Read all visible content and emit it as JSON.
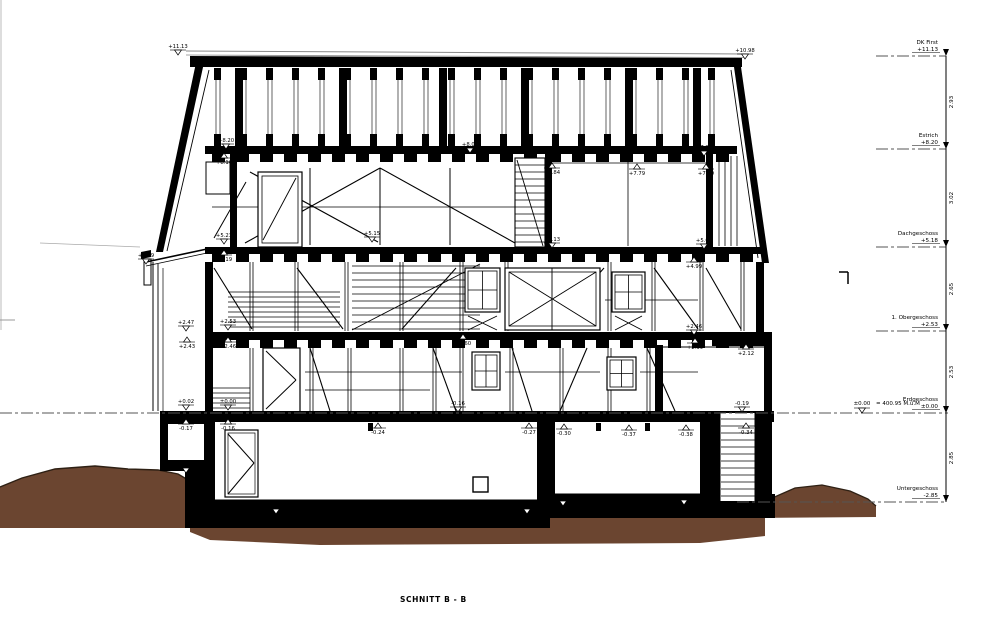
{
  "title": "SCHNITT B - B",
  "datum_note": {
    "label": "±0.00",
    "equals": "= 400.95 M.ü.M"
  },
  "colors": {
    "line": "#000000",
    "soil": "#6B4530",
    "soil_edge": "#2e2014",
    "dash": "#555555",
    "paper": "#ffffff"
  },
  "levels": [
    {
      "name": "DK First",
      "value": "+11.13",
      "y": 56
    },
    {
      "name": "Estrich",
      "value": "+8.20",
      "y": 149
    },
    {
      "name": "Dachgeschoss",
      "value": "+5.18",
      "y": 247
    },
    {
      "name": "1. Obergeschoss",
      "value": "+2.53",
      "y": 331
    },
    {
      "name": "Erdgeschoss",
      "value": "±0.00",
      "y": 413
    },
    {
      "name": "Untergeschoss",
      "value": "-2.85",
      "y": 502
    }
  ],
  "dimensions": [
    {
      "value": "2.93",
      "y": 102
    },
    {
      "value": "3.02",
      "y": 198
    },
    {
      "value": "2.65",
      "y": 289
    },
    {
      "value": "2.53",
      "y": 372
    },
    {
      "value": "2.85",
      "y": 458
    }
  ],
  "annotations": [
    {
      "label": "+11.13",
      "x": 178,
      "y": 46,
      "dir": "down"
    },
    {
      "label": "+10.98",
      "x": 745,
      "y": 50,
      "dir": "down"
    },
    {
      "label": "+8.20",
      "x": 226,
      "y": 140,
      "dir": "down"
    },
    {
      "label": "+8.16",
      "x": 224,
      "y": 162,
      "dir": "up"
    },
    {
      "label": "+8.04",
      "x": 470,
      "y": 144,
      "dir": "down"
    },
    {
      "label": "+7.99",
      "x": 704,
      "y": 147,
      "dir": "down"
    },
    {
      "label": "+7.84",
      "x": 552,
      "y": 172,
      "dir": "up"
    },
    {
      "label": "+7.79",
      "x": 637,
      "y": 173,
      "dir": "up"
    },
    {
      "label": "+7.79",
      "x": 706,
      "y": 173,
      "dir": "up"
    },
    {
      "label": "+5.23",
      "x": 224,
      "y": 235,
      "dir": "down"
    },
    {
      "label": "+5.19",
      "x": 224,
      "y": 259,
      "dir": "up"
    },
    {
      "label": "+5.15",
      "x": 372,
      "y": 233,
      "dir": "down"
    },
    {
      "label": "+5.13",
      "x": 552,
      "y": 239,
      "dir": "down"
    },
    {
      "label": "+5.05",
      "x": 704,
      "y": 240,
      "dir": "down"
    },
    {
      "label": "+4.99",
      "x": 694,
      "y": 266,
      "dir": "up"
    },
    {
      "label": "+4.59",
      "x": 146,
      "y": 255,
      "dir": "down"
    },
    {
      "label": "+2.47",
      "x": 186,
      "y": 322,
      "dir": "down"
    },
    {
      "label": "+2.43",
      "x": 187,
      "y": 346,
      "dir": "up"
    },
    {
      "label": "+2.53",
      "x": 228,
      "y": 321,
      "dir": "down"
    },
    {
      "label": "+2.46",
      "x": 228,
      "y": 346,
      "dir": "up"
    },
    {
      "label": "+2.60",
      "x": 463,
      "y": 343,
      "dir": "up"
    },
    {
      "label": "+2.46",
      "x": 694,
      "y": 326,
      "dir": "down"
    },
    {
      "label": "+2.39",
      "x": 695,
      "y": 347,
      "dir": "up"
    },
    {
      "label": "+2.12",
      "x": 746,
      "y": 353,
      "dir": "up"
    },
    {
      "label": "+0.02",
      "x": 186,
      "y": 401,
      "dir": "down"
    },
    {
      "label": "-0.17",
      "x": 186,
      "y": 428,
      "dir": "up"
    },
    {
      "label": "±0.00",
      "x": 228,
      "y": 401,
      "dir": "down"
    },
    {
      "label": "-0.16",
      "x": 228,
      "y": 428,
      "dir": "up"
    },
    {
      "label": "-0.24",
      "x": 378,
      "y": 432,
      "dir": "up"
    },
    {
      "label": "-0.16",
      "x": 458,
      "y": 403,
      "dir": "down"
    },
    {
      "label": "-0.27",
      "x": 529,
      "y": 432,
      "dir": "up"
    },
    {
      "label": "-0.30",
      "x": 564,
      "y": 433,
      "dir": "up"
    },
    {
      "label": "-0.37",
      "x": 629,
      "y": 434,
      "dir": "up"
    },
    {
      "label": "-0.38",
      "x": 686,
      "y": 434,
      "dir": "up"
    },
    {
      "label": "-0.19",
      "x": 742,
      "y": 403,
      "dir": "down"
    },
    {
      "label": "-0.34",
      "x": 746,
      "y": 432,
      "dir": "up"
    },
    {
      "label": "-1.58",
      "x": 186,
      "y": 464,
      "dir": "down"
    },
    {
      "label": "-3.23",
      "x": 276,
      "y": 505,
      "dir": "down"
    },
    {
      "label": "-3.25",
      "x": 527,
      "y": 505,
      "dir": "down"
    },
    {
      "label": "-3.05",
      "x": 563,
      "y": 497,
      "dir": "down"
    },
    {
      "label": "-3.68",
      "x": 684,
      "y": 496,
      "dir": "down"
    }
  ]
}
